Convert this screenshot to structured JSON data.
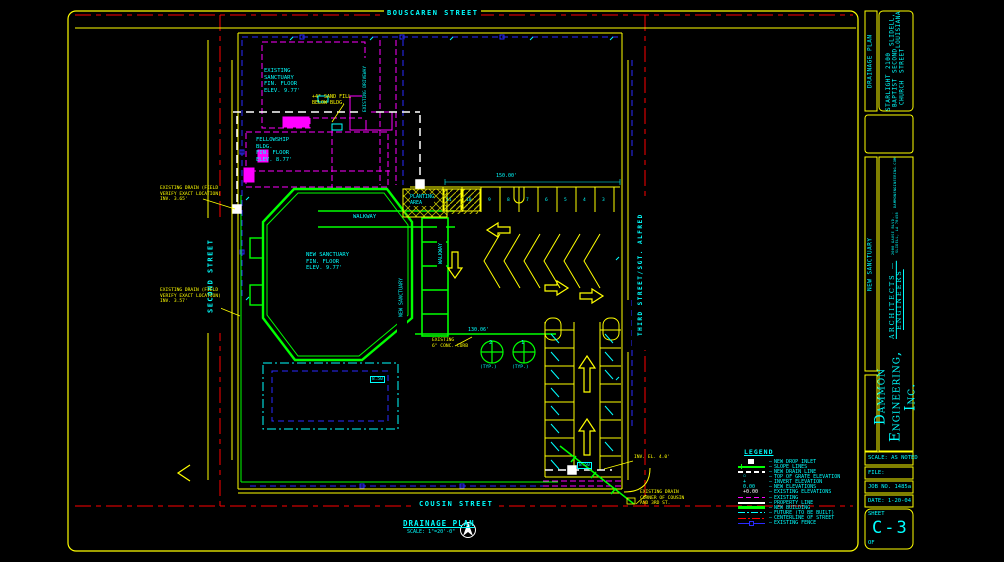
{
  "colors": {
    "background": "#000000",
    "border_yellow": "#ffff00",
    "label_cyan": "#00ffff",
    "centerline_red": "#ff0000",
    "existing_magenta": "#ff00ff",
    "new_building_green": "#00ff00",
    "drain_white": "#ffffff",
    "fence_blue": "#2a2aff"
  },
  "streets": {
    "top": "BOUSCAREN STREET",
    "bottom": "COUSIN STREET",
    "left": "SECOND STREET",
    "right": "THIRD STREET/SGT. ALFRED"
  },
  "plan": {
    "title": "DRAINAGE PLAN",
    "scale": "SCALE: 1\"=20'-0\"",
    "labels": {
      "existing_sanctuary": "EXISTING\nSANCTUARY\nFIN. FLOOR\nELEV. 9.77'",
      "sand_fill": "+4\" SAND FILL\nBELOW BLDG.",
      "fellowship": "FELLOWSHIP\nBLDG.\nFIN. FLOOR\nELEV. 8.77'",
      "new_sanctuary": "NEW SANCTUARY\nFIN. FLOOR\nELEV. 9.77'",
      "new_sanctuary_v": "NEW SANCTUARY",
      "walkway": "WALKWAY",
      "walkway_v": "WALKWAY",
      "planting_area": "PLANTING\nAREA",
      "existing_driveway": "EXISTING DRIVEWAY",
      "drain_note_1": "EXISTING DRAIN (FIELD\nVERIFY EXACT LOCATION)\nINV. 3.65'",
      "drain_note_2": "EXISTING DRAIN (FIELD\nVERIFY EXACT LOCATION)\nINV. 3.57'",
      "curb_note": "EXISTING\n6\" CONC. CURB",
      "drain_note_3": "EXISTING DRAIN\nCORNER OF COUSIN\nAND 3RD ST.",
      "inv_el": "INV. EL. 4.0'",
      "dim_150": "150.00'",
      "dim_130": "130.06'",
      "elev_a": "8.50",
      "elev_b": "8.50",
      "tree_2": "2",
      "tree_1": "1",
      "typ_a": "(TYP.)",
      "typ_b": "(TYP.)"
    },
    "stall_numbers": [
      "11",
      "10",
      "9",
      "8",
      "7",
      "6",
      "5",
      "4",
      "3"
    ]
  },
  "legend": {
    "title": "LEGEND",
    "items": [
      {
        "sym": "inlet",
        "label": "NEW DROP INLET"
      },
      {
        "sym": "slope",
        "label": "SLOPE LINES"
      },
      {
        "sym": "drain",
        "label": "NEW DRAIN LINE"
      },
      {
        "sym": "grate",
        "symtext": "▫",
        "label": "TOP OF GRATE ELEVATION"
      },
      {
        "sym": "invert",
        "symtext": "+",
        "label": "INVERT ELEVATION"
      },
      {
        "sym": "elev-new",
        "symtext": "0.00",
        "label": "NEW ELEVATIONS"
      },
      {
        "sym": "elev-exist",
        "symtext": "+0.00",
        "label": "EXISTING ELEVATIONS"
      },
      {
        "sym": "existing",
        "label": "EXISTING"
      },
      {
        "sym": "property",
        "label": "PROPERTY LINE"
      },
      {
        "sym": "building",
        "label": "NEW BUILDING"
      },
      {
        "sym": "future",
        "label": "FUTURE (TO BE BUILT)"
      },
      {
        "sym": "centerline",
        "label": "CENTERLINE OF STREET"
      },
      {
        "sym": "fence",
        "label": "EXISTING FENCE"
      }
    ]
  },
  "title_block": {
    "drawing_type": "DRAINAGE PLAN",
    "client": [
      "STARLIGHT BAPTIST CHURCH",
      "2100 SECOND STREET",
      "SLIDELL, LOUISIANA"
    ],
    "project": "NEW SANCTUARY",
    "firm": {
      "name": "Dammon Engineering, Inc.",
      "disciplines": "ARCHITECTS — ENGINEERS",
      "address": "2000 GAUSE BLVD. · SLIDELL, LA 70458",
      "web": "DAMMONENGINEERING.COM"
    },
    "scale": "SCALE: AS NOTED",
    "file": "FILE:",
    "job": "JOB NO. 1485a",
    "date": "DATE: 1-20-04",
    "sheet_label": "SHEET",
    "sheet_no": "C-3",
    "of": "OF"
  }
}
